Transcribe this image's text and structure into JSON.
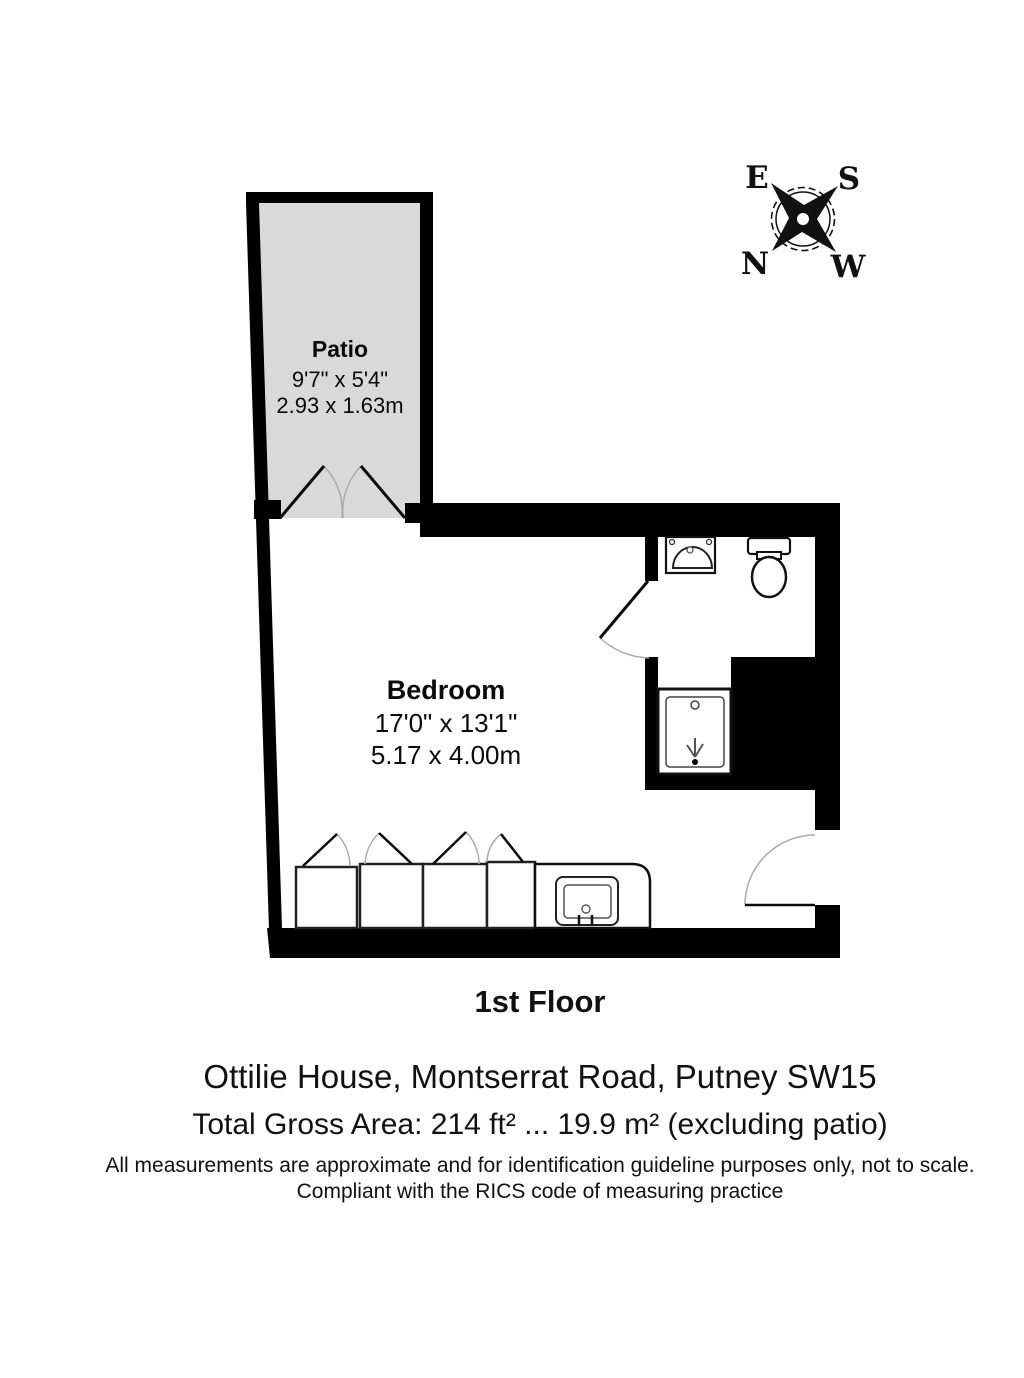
{
  "plan": {
    "floor_label": "1st Floor",
    "rooms": {
      "patio": {
        "name": "Patio",
        "dimensions_imperial": "9'7\" x 5'4\"",
        "dimensions_metric": "2.93 x 1.63m"
      },
      "bedroom": {
        "name": "Bedroom",
        "dimensions_imperial": "17'0\" x 13'1\"",
        "dimensions_metric": "5.17 x 4.00m"
      }
    },
    "compass": {
      "top_left": "E",
      "top_right": "S",
      "bottom_left": "N",
      "bottom_right": "W"
    },
    "colors": {
      "wall": "#000000",
      "patio_fill": "#d9d9d9",
      "background": "#ffffff"
    }
  },
  "footer": {
    "address": "Ottilie House, Montserrat Road, Putney SW15",
    "total_area": "Total Gross Area: 214 ft² ... 19.9 m² (excluding patio)",
    "disclaimer_line1": "All measurements are approximate and for identification guideline purposes only, not to scale.",
    "disclaimer_line2": "Compliant with the RICS code of measuring practice"
  }
}
